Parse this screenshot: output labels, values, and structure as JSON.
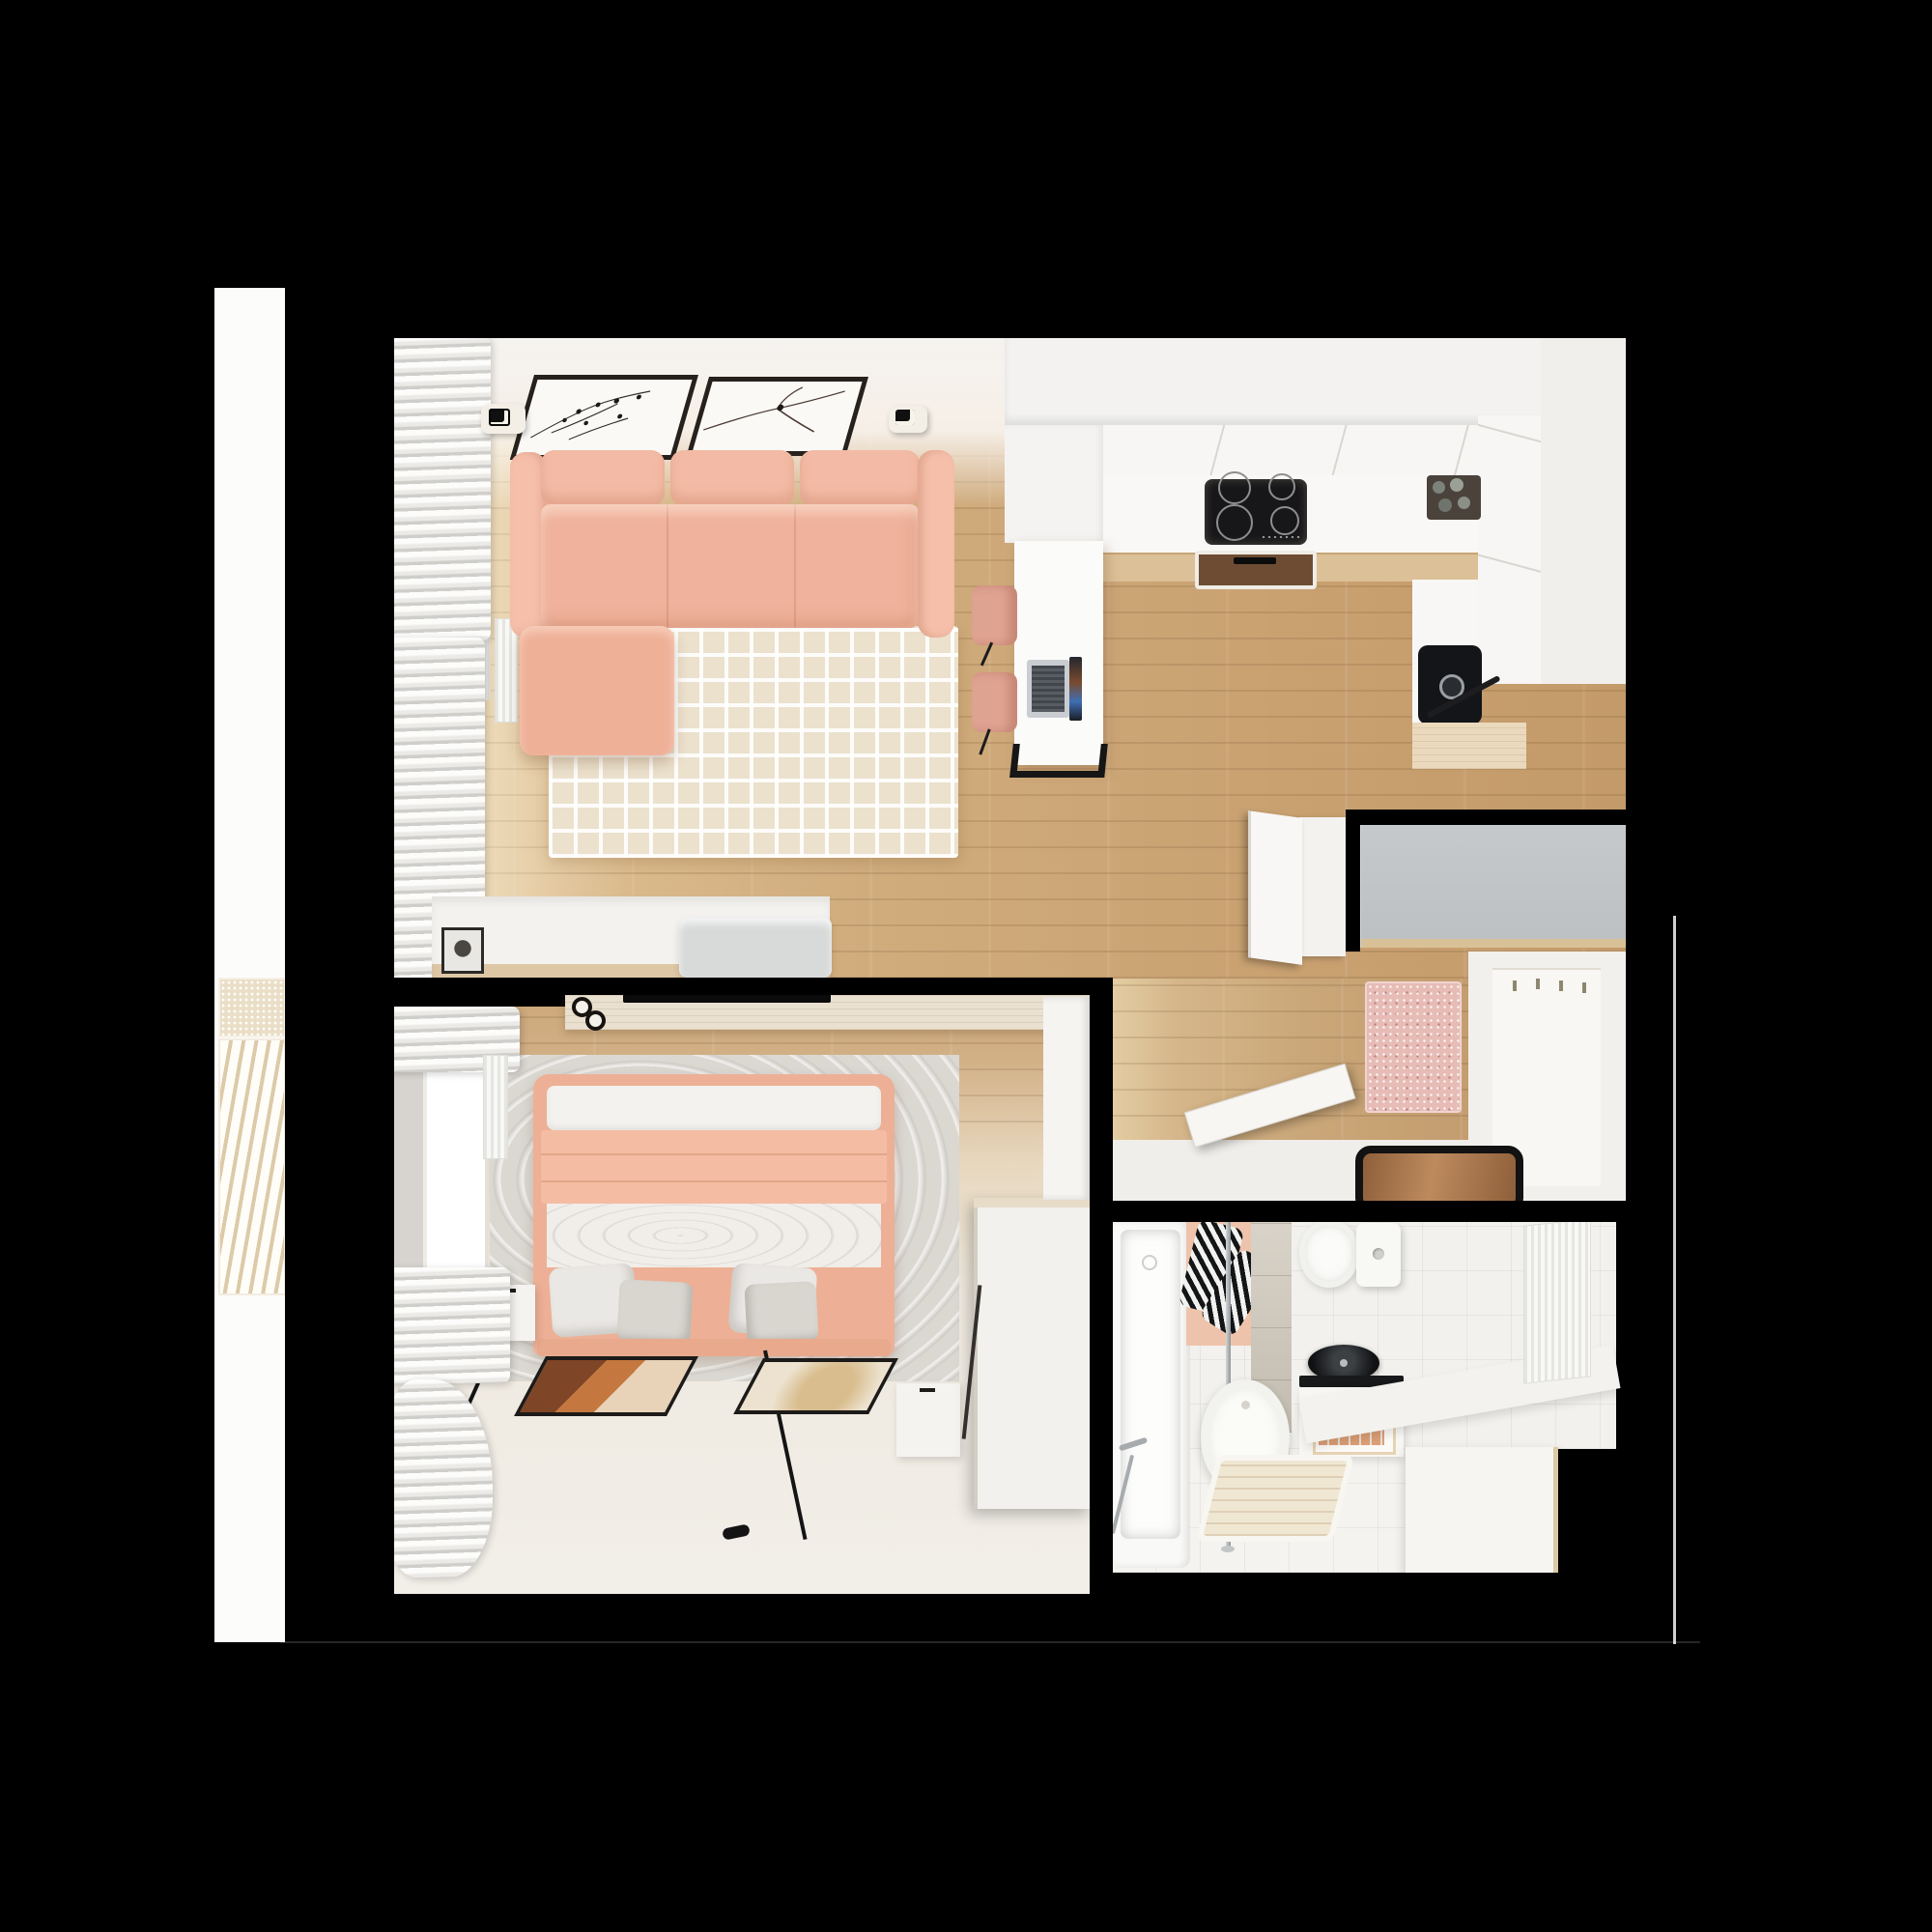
{
  "scene": {
    "kind": "apartment-floor-plan-3d-render",
    "view": "top-down",
    "background": "#000000",
    "rooms": [
      "balcony",
      "living-room",
      "kitchen",
      "hallway",
      "bedroom",
      "bathroom"
    ]
  },
  "palette": {
    "bg": "#000000",
    "wood": "#cda87c",
    "wood_sun": "#ecd6ab",
    "wood_ledge": "#dcc097",
    "wall_white": "#f4f2ef",
    "warm_wall": "#f6efe8",
    "salmon": "#f0b39d",
    "salmon_deep": "#e29b82",
    "cream_rug": "#ebe1cd",
    "gray_rug": "#dbd8d2",
    "gray_closet": "#c6c9cb",
    "pink_rug": "#e7bcb6",
    "mat_brown": "#9b6a42",
    "tile_greige": "#cfc8bb",
    "appliance_black": "#141517",
    "chrome": "#a9aeb1",
    "towel_peach": "#e6a67c",
    "curtain_gray": "#e4e2df"
  },
  "balcony": {
    "features": [
      "perforated-screen-panel",
      "diagonal-slat-screen"
    ]
  },
  "living_room": {
    "furniture": [
      "corner-sofa-salmon",
      "maze-pattern-rug",
      "sideboard",
      "portrait-photo-frame",
      "gray-bench",
      "wall-art-birds",
      "wall-art-branch",
      "ceiling-spotlight-left",
      "ceiling-spotlight-right",
      "window",
      "curtains",
      "radiator"
    ]
  },
  "kitchen": {
    "furniture": [
      "u-shaped-white-counter",
      "induction-cooktop",
      "extractor-hood-inset",
      "black-sink",
      "faucet",
      "corner-tray-with-jars",
      "peninsula-counter",
      "laptop",
      "bar-chair-1",
      "bar-chair-2"
    ]
  },
  "hallway": {
    "furniture": [
      "gray-top-closet",
      "white-cabinet-open-door",
      "coat-rack-unit-with-hooks",
      "pink-speckled-rug",
      "open-door-leaf",
      "entrance-doormat"
    ]
  },
  "bedroom": {
    "furniture": [
      "double-bed-salmon-blanket",
      "pillows",
      "gray-area-rug",
      "tv-shelf",
      "tv",
      "candle-knobs",
      "nightstand-left",
      "nightstand-right",
      "floor-lamp-left",
      "floor-lamp-right",
      "floor-art-terracotta",
      "floor-art-beige",
      "wardrobe",
      "door-leaf",
      "window",
      "curtains",
      "radiator"
    ]
  },
  "bathroom": {
    "furniture": [
      "bathtub",
      "shower-pole",
      "striped-towels",
      "peach-mat",
      "toilet",
      "cistern",
      "black-washbasin",
      "vanity-with-towel-rolls",
      "shower-chair",
      "wooden-shower-tray",
      "towel-radiator",
      "corner-ledge",
      "washer-cabinet",
      "greige-tile-wall"
    ]
  }
}
